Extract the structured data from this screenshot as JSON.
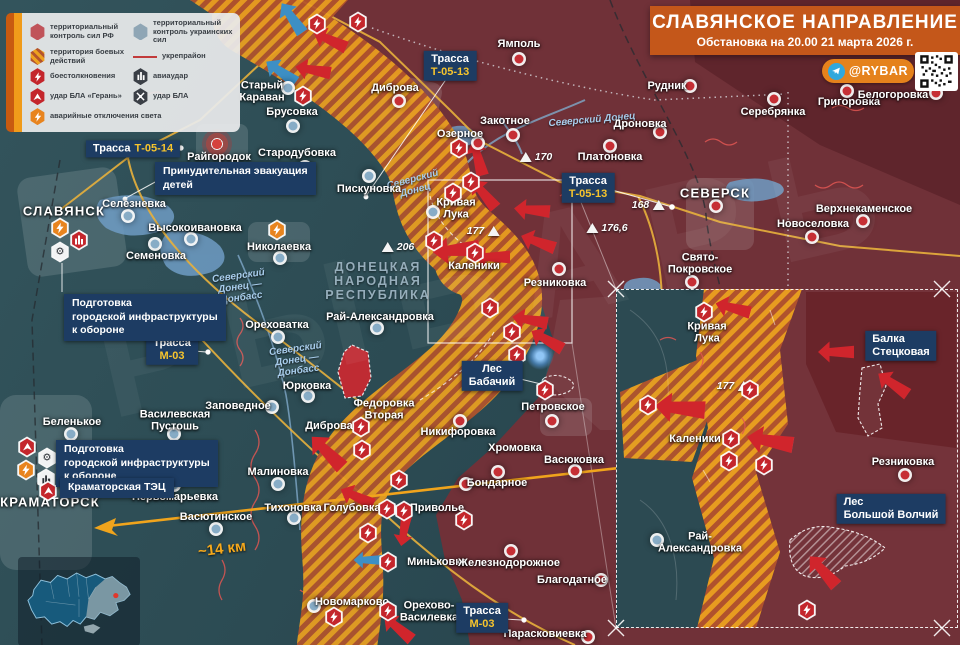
{
  "title": {
    "heading": "СЛАВЯНСКОЕ НАПРАВЛЕНИЕ",
    "subtitle": "Обстановка на 20.00 21 марта 2026 г.",
    "badge": "@RYBAR"
  },
  "watermark": "РЫБАРЬ",
  "legend": {
    "items": [
      {
        "id": "rf-control",
        "label": "территориальный контроль сил РФ"
      },
      {
        "id": "ua-control",
        "label": "территориальный контроль украинских сил"
      },
      {
        "id": "combat-zone",
        "label": "территория боевых действий"
      },
      {
        "id": "fortified-area",
        "label": "укрепрайон"
      },
      {
        "id": "clashes",
        "label": "боестолкновения"
      },
      {
        "id": "airstrike",
        "label": "авиаудар"
      },
      {
        "id": "geran-uav-strike",
        "label": "удар БЛА «Герань»"
      },
      {
        "id": "uav-strike",
        "label": "удар БЛА"
      },
      {
        "id": "power-outages",
        "label": "аварийные отключения света"
      }
    ]
  },
  "colors": {
    "title_orange": "#c4571a",
    "badge_orange": "#e5821c",
    "box_navy": "#1d3c63",
    "rf_zone": "#703138",
    "ua_zone": "#2e4b52",
    "combat_hatch_orange": "#eda11f",
    "road_yellow": "#f6c42d",
    "arrow_red": "#d0252c",
    "marker_red": "#c62f35",
    "marker_blue": "#87acc6"
  },
  "map": {
    "region_label": "ДОНЕЦКАЯ\nНАРОДНАЯ\nРЕСПУБЛИКА",
    "distance_label": "~14 км",
    "towns": [
      {
        "n": "Ямполь",
        "l": [
          519,
          44
        ],
        "m": [
          519,
          59
        ],
        "s": "rf"
      },
      {
        "n": "Старый\nКараван",
        "l": [
          262,
          92
        ],
        "m": [
          288,
          88
        ],
        "s": "ua"
      },
      {
        "n": "Брусовка",
        "l": [
          292,
          112
        ],
        "m": [
          293,
          126
        ],
        "s": "ua"
      },
      {
        "n": "Диброва",
        "l": [
          395,
          88
        ],
        "m": [
          399,
          101
        ],
        "s": "rf"
      },
      {
        "n": "Закотное",
        "l": [
          505,
          121
        ],
        "m": [
          513,
          135
        ],
        "s": "rf"
      },
      {
        "n": "Озерное",
        "l": [
          460,
          134
        ],
        "m": [
          478,
          143
        ],
        "s": "rf"
      },
      {
        "n": "Дроновка",
        "l": [
          640,
          124
        ],
        "m": [
          660,
          132
        ],
        "s": "rf"
      },
      {
        "n": "Платоновка",
        "l": [
          610,
          157
        ],
        "m": [
          610,
          146
        ],
        "s": "rf"
      },
      {
        "n": "Рудник",
        "l": [
          667,
          86
        ],
        "m": [
          690,
          86
        ],
        "s": "rf"
      },
      {
        "n": "Серебрянка",
        "l": [
          773,
          112
        ],
        "m": [
          774,
          99
        ],
        "s": "rf"
      },
      {
        "n": "Григоровка",
        "l": [
          849,
          102
        ],
        "m": [
          847,
          91
        ],
        "s": "rf"
      },
      {
        "n": "Белогоровка",
        "l": [
          893,
          95
        ],
        "m": [
          936,
          93
        ],
        "s": "rf"
      },
      {
        "n": "Верхнекаменское",
        "l": [
          864,
          209
        ],
        "m": [
          863,
          221
        ],
        "s": "rf"
      },
      {
        "n": "Новоселовка",
        "l": [
          813,
          224
        ],
        "m": [
          812,
          237
        ],
        "s": "rf"
      },
      {
        "n": "Свято-\nПокровское",
        "l": [
          700,
          264
        ],
        "m": [
          692,
          282
        ],
        "s": "rf"
      },
      {
        "n": "Резниковка",
        "l": [
          555,
          283
        ],
        "m": [
          559,
          269
        ],
        "s": "rf"
      },
      {
        "n": "Стародубовка",
        "l": [
          297,
          153
        ],
        "m": [
          305,
          167
        ],
        "s": "ua"
      },
      {
        "n": "Пискуновка",
        "l": [
          369,
          189
        ],
        "m": [
          369,
          176
        ],
        "s": "ua"
      },
      {
        "n": "Кривая\nЛука",
        "l": [
          456,
          209
        ],
        "m": [
          433,
          212
        ],
        "s": "ua"
      },
      {
        "n": "Каленики",
        "l": [
          474,
          266
        ]
      },
      {
        "n": "Райгородок",
        "l": [
          219,
          157
        ]
      },
      {
        "n": "Селезневка",
        "l": [
          134,
          204
        ],
        "m": [
          128,
          216
        ],
        "s": "ua"
      },
      {
        "n": "Высокоивановка",
        "l": [
          195,
          228
        ],
        "m": [
          191,
          239
        ],
        "s": "ua"
      },
      {
        "n": "Семеновка",
        "l": [
          156,
          256
        ],
        "m": [
          155,
          244
        ],
        "s": "ua"
      },
      {
        "n": "Николаевка",
        "l": [
          279,
          247
        ],
        "m": [
          280,
          258
        ],
        "s": "ua"
      },
      {
        "n": "Ореховатка",
        "l": [
          277,
          325
        ],
        "m": [
          278,
          337
        ],
        "s": "ua"
      },
      {
        "n": "Рай-Александровка",
        "l": [
          380,
          317
        ],
        "m": [
          377,
          328
        ],
        "s": "ua"
      },
      {
        "n": "Юрковка",
        "l": [
          307,
          386
        ],
        "m": [
          308,
          396
        ],
        "s": "ua"
      },
      {
        "n": "Заповедное",
        "l": [
          238,
          406
        ],
        "m": [
          272,
          407
        ],
        "s": "ua"
      },
      {
        "n": "Василевская\nПустошь",
        "l": [
          175,
          421
        ],
        "m": [
          174,
          434
        ],
        "s": "ua"
      },
      {
        "n": "Беленькое",
        "l": [
          72,
          422
        ],
        "m": [
          71,
          434
        ],
        "s": "ua"
      },
      {
        "n": "Федоровка\nВторая",
        "l": [
          384,
          410
        ]
      },
      {
        "n": "Диброва",
        "l": [
          329,
          426
        ]
      },
      {
        "n": "Никифоровка",
        "l": [
          458,
          432
        ],
        "m": [
          460,
          421
        ],
        "s": "rf"
      },
      {
        "n": "Хромовка",
        "l": [
          515,
          448
        ],
        "m": [
          498,
          472
        ],
        "s": "rf"
      },
      {
        "n": "Васюковка",
        "l": [
          574,
          460
        ],
        "m": [
          575,
          471
        ],
        "s": "rf"
      },
      {
        "n": "Бондарное",
        "l": [
          497,
          483
        ],
        "m": [
          466,
          484
        ],
        "s": "rf"
      },
      {
        "n": "Петровское",
        "l": [
          553,
          407
        ],
        "m": [
          552,
          421
        ],
        "s": "rf"
      },
      {
        "n": "Малиновка",
        "l": [
          278,
          472
        ],
        "m": [
          278,
          484
        ],
        "s": "ua"
      },
      {
        "n": "Тихоновка",
        "l": [
          293,
          508
        ],
        "m": [
          294,
          518
        ],
        "s": "ua"
      },
      {
        "n": "Голубовка",
        "l": [
          352,
          508
        ]
      },
      {
        "n": "Приволье",
        "l": [
          437,
          508
        ]
      },
      {
        "n": "Первомарьевка",
        "l": [
          175,
          497
        ],
        "m": [
          174,
          485
        ],
        "s": "ua"
      },
      {
        "n": "Васютинское",
        "l": [
          216,
          517
        ],
        "m": [
          216,
          529
        ],
        "s": "ua"
      },
      {
        "n": "Миньковка",
        "l": [
          437,
          562
        ]
      },
      {
        "n": "Железнодорожное",
        "l": [
          509,
          563
        ],
        "m": [
          511,
          551
        ],
        "s": "rf"
      },
      {
        "n": "Благодатное",
        "l": [
          572,
          580
        ],
        "m": [
          601,
          580
        ],
        "s": "rf"
      },
      {
        "n": "Новомарково",
        "l": [
          352,
          602
        ],
        "m": [
          314,
          606
        ],
        "s": "ua"
      },
      {
        "n": "Орехово-\nВасилевка",
        "l": [
          429,
          612
        ]
      },
      {
        "n": "Парасковиевка",
        "l": [
          545,
          634
        ],
        "m": [
          588,
          637
        ],
        "s": "rf"
      },
      {
        "n": "СЛАВЯНСК",
        "l": [
          64,
          212
        ],
        "city": true
      },
      {
        "n": "КРАМАТОРСК",
        "l": [
          50,
          503
        ],
        "city": true
      },
      {
        "n": "СЕВЕРСК",
        "l": [
          715,
          194
        ],
        "m": [
          716,
          206
        ],
        "s": "rf",
        "city": true
      },
      {
        "n": "Кривая\nЛука",
        "l": [
          707,
          333
        ]
      },
      {
        "n": "Каленики",
        "l": [
          695,
          439
        ]
      },
      {
        "n": "Резниковка",
        "l": [
          903,
          462
        ],
        "m": [
          905,
          475
        ],
        "s": "rf"
      },
      {
        "n": "Рай-\nАлександровка",
        "l": [
          700,
          543
        ],
        "m": [
          657,
          540
        ],
        "s": "ua"
      }
    ],
    "boxes": [
      {
        "x": 450,
        "y": 66,
        "lines": [
          [
            {
              "t": "Трасса",
              "c": "w"
            }
          ],
          [
            {
              "t": "Т-05-13",
              "c": "y"
            }
          ]
        ]
      },
      {
        "x": 588,
        "y": 188,
        "lines": [
          [
            {
              "t": "Трасса",
              "c": "w"
            }
          ],
          [
            {
              "t": "Т-05-13",
              "c": "y"
            }
          ]
        ]
      },
      {
        "x": 133,
        "y": 149,
        "lines": [
          [
            {
              "t": "Трасса",
              "c": "w"
            },
            {
              "t": "Т-05-14",
              "c": "y"
            }
          ]
        ]
      },
      {
        "x": 172,
        "y": 350,
        "lines": [
          [
            {
              "t": "Трасса",
              "c": "w"
            }
          ],
          [
            {
              "t": "М-03",
              "c": "y"
            }
          ]
        ]
      },
      {
        "x": 482,
        "y": 618,
        "lines": [
          [
            {
              "t": "Трасса",
              "c": "w"
            }
          ],
          [
            {
              "t": "М-03",
              "c": "y"
            }
          ]
        ]
      },
      {
        "x": 492,
        "y": 376,
        "lines": [
          [
            {
              "t": "Лес",
              "c": "w"
            }
          ],
          [
            {
              "t": "Бабачий",
              "c": "w"
            }
          ]
        ]
      },
      {
        "x": 901,
        "y": 346,
        "align": "left",
        "lines": [
          [
            {
              "t": "Балка",
              "c": "w"
            }
          ],
          [
            {
              "t": "Стецковая",
              "c": "w"
            }
          ]
        ]
      },
      {
        "x": 891,
        "y": 509,
        "align": "left",
        "lines": [
          [
            {
              "t": "Лес",
              "c": "w"
            }
          ],
          [
            {
              "t": "Большой Волчий",
              "c": "w"
            }
          ]
        ]
      }
    ],
    "annotations": [
      {
        "x": 155,
        "y": 162,
        "text": "Принудительная эвакуация\nдетей"
      },
      {
        "x": 64,
        "y": 294,
        "text": "Подготовка\nгородской инфраструктуры\nк обороне"
      },
      {
        "x": 56,
        "y": 440,
        "text": "Подготовка\nгородской инфраструктуры\nк обороне"
      },
      {
        "x": 60,
        "y": 478,
        "text": "Краматорская ТЭЦ"
      }
    ],
    "elevations": [
      {
        "x": 536,
        "y": 157,
        "v": "170",
        "side": "right"
      },
      {
        "x": 648,
        "y": 205,
        "v": "168",
        "side": "left"
      },
      {
        "x": 607,
        "y": 228,
        "v": "176,6",
        "side": "right"
      },
      {
        "x": 483,
        "y": 231,
        "v": "177",
        "side": "left"
      },
      {
        "x": 398,
        "y": 247,
        "v": "206",
        "side": "right"
      },
      {
        "x": 733,
        "y": 386,
        "v": "177",
        "side": "left"
      }
    ],
    "rivers": [
      {
        "t": "Северский\nДонец",
        "x": 414,
        "y": 185,
        "r": -15
      },
      {
        "t": "Северский Донец",
        "x": 592,
        "y": 120,
        "r": -5
      },
      {
        "t": "Северский\nДонец —\nДонбасс",
        "x": 240,
        "y": 287,
        "r": -8
      },
      {
        "t": "Северский\nДонец —\nДонбасс",
        "x": 297,
        "y": 360,
        "r": -8
      }
    ],
    "icons": [
      {
        "t": "clash",
        "x": 317,
        "y": 24
      },
      {
        "t": "clash",
        "x": 358,
        "y": 22
      },
      {
        "t": "clash",
        "x": 303,
        "y": 96
      },
      {
        "t": "clash",
        "x": 459,
        "y": 148
      },
      {
        "t": "clash",
        "x": 471,
        "y": 182
      },
      {
        "t": "clash",
        "x": 453,
        "y": 193
      },
      {
        "t": "clash",
        "x": 434,
        "y": 241
      },
      {
        "t": "clash",
        "x": 475,
        "y": 253
      },
      {
        "t": "clash",
        "x": 490,
        "y": 308
      },
      {
        "t": "clash",
        "x": 512,
        "y": 332
      },
      {
        "t": "clash",
        "x": 517,
        "y": 355
      },
      {
        "t": "clash",
        "x": 545,
        "y": 390
      },
      {
        "t": "clash",
        "x": 361,
        "y": 427
      },
      {
        "t": "clash",
        "x": 362,
        "y": 450
      },
      {
        "t": "clash",
        "x": 399,
        "y": 480
      },
      {
        "t": "clash",
        "x": 387,
        "y": 509
      },
      {
        "t": "clash",
        "x": 404,
        "y": 511
      },
      {
        "t": "clash",
        "x": 368,
        "y": 533
      },
      {
        "t": "clash",
        "x": 464,
        "y": 520
      },
      {
        "t": "clash",
        "x": 388,
        "y": 562
      },
      {
        "t": "clash",
        "x": 334,
        "y": 617
      },
      {
        "t": "clash",
        "x": 388,
        "y": 611
      },
      {
        "t": "outage",
        "x": 277,
        "y": 230
      },
      {
        "t": "outage",
        "x": 60,
        "y": 228
      },
      {
        "t": "avia_red",
        "x": 79,
        "y": 240
      },
      {
        "t": "gear",
        "x": 60,
        "y": 252
      },
      {
        "t": "geran",
        "x": 27,
        "y": 447
      },
      {
        "t": "gear",
        "x": 47,
        "y": 458
      },
      {
        "t": "outage",
        "x": 26,
        "y": 470
      },
      {
        "t": "tec",
        "x": 46,
        "y": 479
      },
      {
        "t": "geran",
        "x": 48,
        "y": 491
      },
      {
        "t": "boom",
        "x": 217,
        "y": 144
      },
      {
        "t": "glow",
        "x": 540,
        "y": 356
      },
      {
        "t": "clash",
        "x": 704,
        "y": 312
      },
      {
        "t": "clash",
        "x": 750,
        "y": 390
      },
      {
        "t": "clash",
        "x": 731,
        "y": 439
      },
      {
        "t": "clash",
        "x": 729,
        "y": 461
      },
      {
        "t": "clash",
        "x": 648,
        "y": 405
      },
      {
        "t": "clash",
        "x": 764,
        "y": 465
      },
      {
        "t": "clash",
        "x": 807,
        "y": 610
      }
    ],
    "arrows": [
      {
        "x": 330,
        "y": 40,
        "r": 25
      },
      {
        "x": 313,
        "y": 70,
        "r": 10
      },
      {
        "x": 478,
        "y": 158,
        "r": 75
      },
      {
        "x": 484,
        "y": 194,
        "r": 50
      },
      {
        "x": 532,
        "y": 210,
        "r": 5
      },
      {
        "x": 538,
        "y": 242,
        "r": 20
      },
      {
        "x": 492,
        "y": 257,
        "r": 0
      },
      {
        "x": 456,
        "y": 250,
        "r": -5,
        "s": 1.3
      },
      {
        "x": 530,
        "y": 320,
        "r": 10
      },
      {
        "x": 547,
        "y": 340,
        "r": 30
      },
      {
        "x": 327,
        "y": 452,
        "r": 45,
        "s": 1.2
      },
      {
        "x": 357,
        "y": 497,
        "r": 25
      },
      {
        "x": 404,
        "y": 530,
        "r": -80,
        "s": 0.9
      },
      {
        "x": 398,
        "y": 628,
        "r": 40
      },
      {
        "x": 368,
        "y": 560,
        "r": 0,
        "c": "blue",
        "s": 0.8
      },
      {
        "x": 292,
        "y": 18,
        "r": 55,
        "c": "blue"
      },
      {
        "x": 281,
        "y": 72,
        "r": 35,
        "c": "blue"
      },
      {
        "x": 733,
        "y": 308,
        "r": 15
      },
      {
        "x": 836,
        "y": 352,
        "r": 0
      },
      {
        "x": 893,
        "y": 384,
        "r": 35
      },
      {
        "x": 680,
        "y": 408,
        "r": 5,
        "s": 1.4
      },
      {
        "x": 770,
        "y": 441,
        "r": 10,
        "s": 1.3
      },
      {
        "x": 823,
        "y": 571,
        "r": 48,
        "s": 1.1
      }
    ]
  }
}
